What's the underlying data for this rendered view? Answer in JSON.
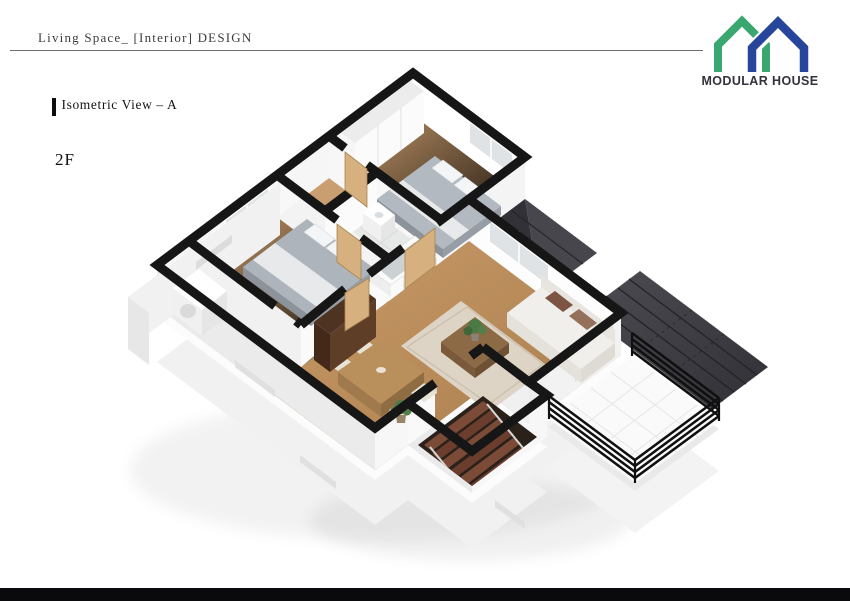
{
  "header": {
    "title": "Living Space_ [Interior] DESIGN"
  },
  "logo": {
    "brand": "MODULAR HOUSE"
  },
  "view": {
    "title": "Isometric View – A",
    "floor_label": "2F"
  },
  "colors": {
    "logo_green": "#3aa670",
    "logo_blue": "#27459b",
    "footer_bar": "#0a0a0c",
    "wall_cap": "#161616",
    "wood_floor": "#c0925f",
    "roof_dark": "#3e3e44",
    "bedding_gray": "#aeb4bc"
  },
  "scene": {
    "name": "isometric-floorplan-2f",
    "rooms": [
      "bedroom-top",
      "bathroom",
      "bedroom-left",
      "hallway",
      "living-room",
      "dining-area",
      "stairwell",
      "balcony",
      "utility-room"
    ]
  }
}
